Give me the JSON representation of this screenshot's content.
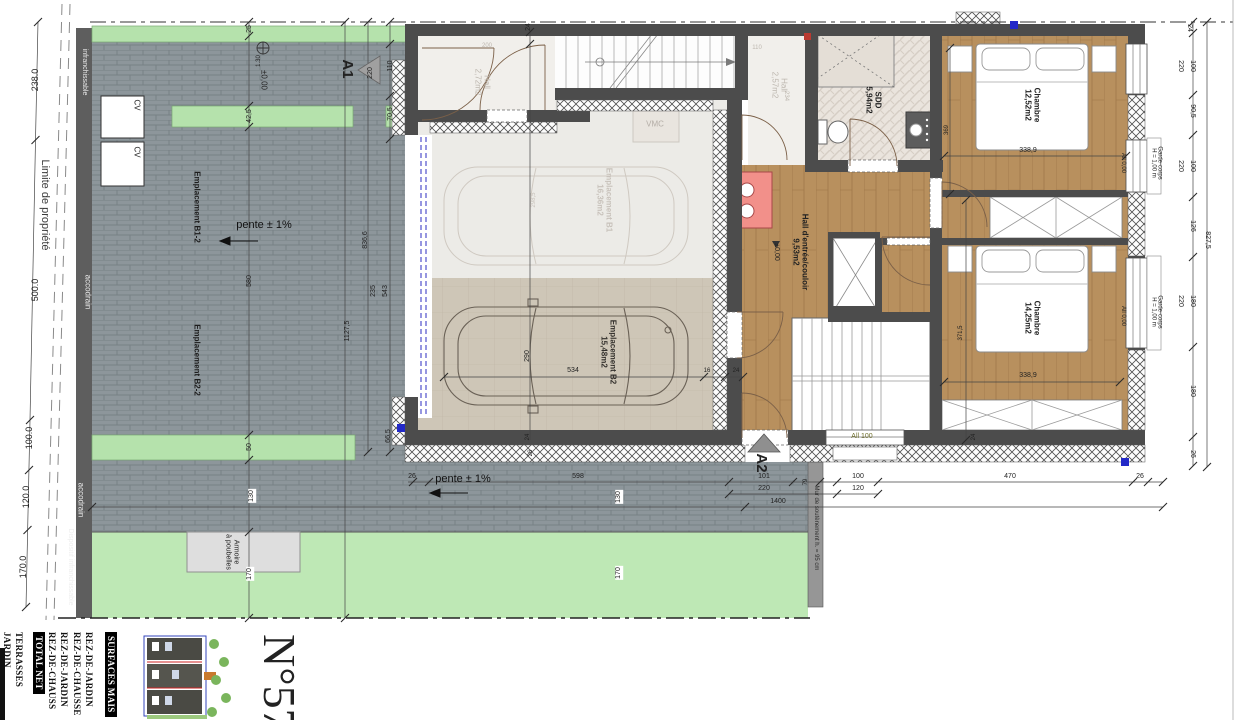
{
  "sheet_number": "N°57",
  "colors": {
    "wall": "#4c4c4c",
    "wood": "#b8905e",
    "paving": "#8d969b",
    "planting_green": "#b5e2ac",
    "lawn_green": "#bee8b5",
    "accent_blue": "#2329c8",
    "accent_red": "#ba3a31",
    "accent_pink": "#f2908a"
  },
  "rooms": [
    {
      "name": "Hall",
      "area": "2,72m2"
    },
    {
      "name": "Hall",
      "area": "2,57m2"
    },
    {
      "name": "SDD",
      "area": "5,94m2"
    },
    {
      "name": "Hall d'entrée/couloir",
      "area": "9,53m2"
    },
    {
      "name": "Chambre",
      "area": "12,52m2"
    },
    {
      "name": "Chambre",
      "area": "14,25m2"
    },
    {
      "name": "Emplacement B1",
      "area": "16,36m2"
    },
    {
      "name": "Emplacement B2",
      "area": "15,48m2"
    },
    {
      "name": "Emplacement B1-2"
    },
    {
      "name": "Emplacement B2-2"
    }
  ],
  "surface_table": {
    "columns": [
      {
        "t": "JARDIN",
        "x": 12
      },
      {
        "t": "TERRASSES",
        "x": 24
      },
      {
        "t": "TOTAL NET",
        "x": 45,
        "header": true
      },
      {
        "t": "REZ-DE-CHAUSS",
        "x": 57
      },
      {
        "t": "REZ-DE-JARDIN",
        "x": 69
      },
      {
        "t": "REZ-DE-CHAUSSE",
        "x": 82
      },
      {
        "t": "REZ-DE-JARDIN",
        "x": 94
      },
      {
        "t": "SURFACES MAIS",
        "x": 117,
        "header": true
      }
    ]
  },
  "labels": [
    {
      "t": "238.0",
      "x": 36,
      "y": 80,
      "r": -90,
      "s": 9
    },
    {
      "t": "Limite de propriété",
      "x": 44,
      "y": 205,
      "r": 90,
      "s": 11,
      "c": "#3a3a3a"
    },
    {
      "t": "500.0",
      "x": 36,
      "y": 290,
      "r": -90,
      "s": 9
    },
    {
      "t": "100.0",
      "x": 30,
      "y": 438,
      "r": -90,
      "s": 9
    },
    {
      "t": "120.0",
      "x": 27,
      "y": 497,
      "r": -90,
      "s": 9
    },
    {
      "t": "170.0",
      "x": 24,
      "y": 567,
      "r": -90,
      "s": 9
    },
    {
      "t": "infranchissable",
      "x": 84,
      "y": 72,
      "r": 90,
      "s": 7,
      "c": "#e8e8e8"
    },
    {
      "t": "accodrain",
      "x": 87,
      "y": 292,
      "r": 90,
      "s": 8,
      "c": "#ebebeb"
    },
    {
      "t": "accodrain",
      "x": 80,
      "y": 500,
      "r": 90,
      "s": 8,
      "c": "#ebebeb"
    },
    {
      "t": "Dispositif infranchissable",
      "x": 70,
      "y": 567,
      "r": 90,
      "s": 7,
      "c": "#eeeeee"
    },
    {
      "t": "CV",
      "x": 136,
      "y": 105,
      "r": 90,
      "s": 8
    },
    {
      "t": "CV",
      "x": 136,
      "y": 152,
      "r": 90,
      "s": 8
    },
    {
      "t": "Emplacement B1-2",
      "x": 196,
      "y": 207,
      "r": 90,
      "s": 8,
      "c": "#1d1d1d",
      "b": 1
    },
    {
      "t": "Emplacement B2-2",
      "x": 196,
      "y": 360,
      "r": 90,
      "s": 8,
      "c": "#1d1d1d",
      "b": 1
    },
    {
      "t": "pente ± 1%",
      "x": 264,
      "y": 226,
      "s": 11,
      "c": "#111"
    },
    {
      "t": "pente ± 1%",
      "x": 463,
      "y": 480,
      "s": 11,
      "c": "#111"
    },
    {
      "t": "±0,00",
      "x": 263,
      "y": 80,
      "r": 90,
      "s": 8
    },
    {
      "t": "A1",
      "x": 347,
      "y": 69,
      "r": 90,
      "s": 15,
      "b": 1
    },
    {
      "t": "A2",
      "x": 761,
      "y": 463,
      "r": 90,
      "s": 15,
      "b": 1
    },
    {
      "t": "Armoire\nà poubelles",
      "x": 232,
      "y": 552,
      "r": 90,
      "s": 7
    },
    {
      "t": "Mur de soutènement h. = 95 cm",
      "x": 816,
      "y": 528,
      "r": 90,
      "s": 6,
      "c": "#2f2f2f"
    },
    {
      "t": "25",
      "x": 250,
      "y": 29,
      "r": -90,
      "s": 7
    },
    {
      "t": "1.30",
      "x": 259,
      "y": 61,
      "r": -90,
      "s": 6
    },
    {
      "t": "42,5",
      "x": 250,
      "y": 116,
      "r": -90,
      "s": 7
    },
    {
      "t": "580",
      "x": 250,
      "y": 281,
      "r": -90,
      "s": 7
    },
    {
      "t": "50",
      "x": 250,
      "y": 447,
      "r": -90,
      "s": 7
    },
    {
      "t": "130",
      "x": 252,
      "y": 496,
      "r": -90,
      "s": 7,
      "bg": "#fff"
    },
    {
      "t": "170",
      "x": 250,
      "y": 574,
      "r": -90,
      "s": 7,
      "bg": "#fff"
    },
    {
      "t": "220",
      "x": 371,
      "y": 73,
      "r": -90,
      "s": 7
    },
    {
      "t": "110",
      "x": 391,
      "y": 66,
      "r": -90,
      "s": 7
    },
    {
      "t": "70,5",
      "x": 391,
      "y": 114,
      "r": -90,
      "s": 7
    },
    {
      "t": "836,6",
      "x": 366,
      "y": 240,
      "r": -90,
      "s": 7
    },
    {
      "t": "543",
      "x": 386,
      "y": 291,
      "r": -90,
      "s": 7
    },
    {
      "t": "235",
      "x": 374,
      "y": 291,
      "r": -90,
      "s": 7
    },
    {
      "t": "1127,5",
      "x": 348,
      "y": 331,
      "r": -90,
      "s": 7
    },
    {
      "t": "66,5",
      "x": 389,
      "y": 436,
      "r": -90,
      "s": 7
    },
    {
      "t": "130",
      "x": 619,
      "y": 497,
      "r": -90,
      "s": 7,
      "bg": "#fff"
    },
    {
      "t": "170",
      "x": 619,
      "y": 573,
      "r": -90,
      "s": 7,
      "bg": "#fff"
    },
    {
      "t": "1400",
      "x": 778,
      "y": 502,
      "s": 7
    },
    {
      "t": "26",
      "x": 412,
      "y": 477,
      "s": 7
    },
    {
      "t": "598",
      "x": 578,
      "y": 477,
      "s": 7
    },
    {
      "t": "101",
      "x": 764,
      "y": 477,
      "s": 7
    },
    {
      "t": "220",
      "x": 764,
      "y": 489,
      "s": 7
    },
    {
      "t": "79",
      "x": 806,
      "y": 482,
      "r": -90,
      "s": 6
    },
    {
      "t": "100",
      "x": 858,
      "y": 477,
      "s": 7
    },
    {
      "t": "120",
      "x": 858,
      "y": 489,
      "s": 7
    },
    {
      "t": "470",
      "x": 1010,
      "y": 477,
      "s": 7
    },
    {
      "t": "26",
      "x": 1140,
      "y": 477,
      "s": 7
    },
    {
      "t": "24",
      "x": 529,
      "y": 27,
      "r": -90,
      "s": 7
    },
    {
      "t": "290",
      "x": 528,
      "y": 356,
      "r": -90,
      "s": 7
    },
    {
      "t": "534",
      "x": 573,
      "y": 371,
      "s": 7
    },
    {
      "t": "16",
      "x": 707,
      "y": 371,
      "s": 6
    },
    {
      "t": "24",
      "x": 736,
      "y": 371,
      "s": 6
    },
    {
      "t": "24",
      "x": 528,
      "y": 437,
      "r": -90,
      "s": 6
    },
    {
      "t": "26",
      "x": 531,
      "y": 453,
      "r": -90,
      "s": 6
    },
    {
      "t": "VMC",
      "x": 655,
      "y": 125,
      "s": 8,
      "c": "#b3ada6"
    },
    {
      "t": "Hall\n2,72m2",
      "x": 482,
      "y": 82,
      "r": 90,
      "s": 8,
      "c": "#bdb7af"
    },
    {
      "t": "200",
      "x": 487,
      "y": 46,
      "s": 6,
      "c": "#bdb7af"
    },
    {
      "t": "Hall\n2,57m2",
      "x": 779,
      "y": 85,
      "r": 90,
      "s": 8,
      "c": "#bdb7af"
    },
    {
      "t": "110",
      "x": 757,
      "y": 48,
      "s": 6,
      "c": "#bdb7af"
    },
    {
      "t": "234",
      "x": 786,
      "y": 96,
      "r": 90,
      "s": 6,
      "c": "#bdb7af"
    },
    {
      "t": "Emplacement B1\n16,36m2",
      "x": 604,
      "y": 200,
      "r": 90,
      "s": 8,
      "c": "#c8c2bb",
      "b": 1
    },
    {
      "t": "298,5",
      "x": 534,
      "y": 200,
      "r": -90,
      "s": 6,
      "c": "#c8c2bb"
    },
    {
      "t": "Emplacement B2\n15,48m2",
      "x": 608,
      "y": 352,
      "r": 90,
      "s": 8,
      "c": "#33302c",
      "b": 1
    },
    {
      "t": "SDD\n5,94m2",
      "x": 873,
      "y": 100,
      "r": 90,
      "s": 8,
      "b": 1
    },
    {
      "t": "Hall d'entrée/couloir\n9,53m2",
      "x": 800,
      "y": 252,
      "r": 90,
      "s": 8,
      "b": 1
    },
    {
      "t": "±0,00",
      "x": 776,
      "y": 252,
      "r": 90,
      "s": 7
    },
    {
      "t": "Chambre\n12,52m2",
      "x": 1032,
      "y": 105,
      "r": 90,
      "s": 8,
      "b": 1
    },
    {
      "t": "Chambre\n14,25m2",
      "x": 1032,
      "y": 318,
      "r": 90,
      "s": 8,
      "b": 1
    },
    {
      "t": "338,9",
      "x": 1028,
      "y": 151,
      "s": 7
    },
    {
      "t": "338,9",
      "x": 1028,
      "y": 376,
      "s": 7
    },
    {
      "t": "369",
      "x": 947,
      "y": 130,
      "r": -90,
      "s": 6
    },
    {
      "t": "371,5",
      "x": 961,
      "y": 333,
      "r": -90,
      "s": 6
    },
    {
      "t": "24",
      "x": 974,
      "y": 437,
      "r": -90,
      "s": 6
    },
    {
      "t": "All 100",
      "x": 862,
      "y": 437,
      "s": 7,
      "c": "#6f6f2d"
    },
    {
      "t": "All 0,00",
      "x": 1123,
      "y": 163,
      "r": 90,
      "s": 6
    },
    {
      "t": "All 0,00",
      "x": 1123,
      "y": 316,
      "r": 90,
      "s": 6
    },
    {
      "t": "24",
      "x": 1189,
      "y": 28,
      "r": 90,
      "s": 7
    },
    {
      "t": "220",
      "x": 1180,
      "y": 66,
      "r": 90,
      "s": 7
    },
    {
      "t": "100",
      "x": 1192,
      "y": 66,
      "r": 90,
      "s": 7
    },
    {
      "t": "90,5",
      "x": 1192,
      "y": 111,
      "r": 90,
      "s": 7
    },
    {
      "t": "Garde-corps\nH = 1,00 m",
      "x": 1156,
      "y": 163,
      "r": 90,
      "s": 6
    },
    {
      "t": "220",
      "x": 1180,
      "y": 166,
      "r": 90,
      "s": 7
    },
    {
      "t": "100",
      "x": 1192,
      "y": 166,
      "r": 90,
      "s": 7
    },
    {
      "t": "126",
      "x": 1192,
      "y": 226,
      "r": 90,
      "s": 7
    },
    {
      "t": "827,5",
      "x": 1207,
      "y": 240,
      "r": 90,
      "s": 7
    },
    {
      "t": "220",
      "x": 1180,
      "y": 301,
      "r": 90,
      "s": 7
    },
    {
      "t": "180",
      "x": 1192,
      "y": 301,
      "r": 90,
      "s": 7
    },
    {
      "t": "Garde-corps\nH = 1,00 m",
      "x": 1156,
      "y": 312,
      "r": 90,
      "s": 6
    },
    {
      "t": "180",
      "x": 1192,
      "y": 391,
      "r": 90,
      "s": 7
    },
    {
      "t": "26",
      "x": 1192,
      "y": 454,
      "r": 90,
      "s": 7
    }
  ]
}
